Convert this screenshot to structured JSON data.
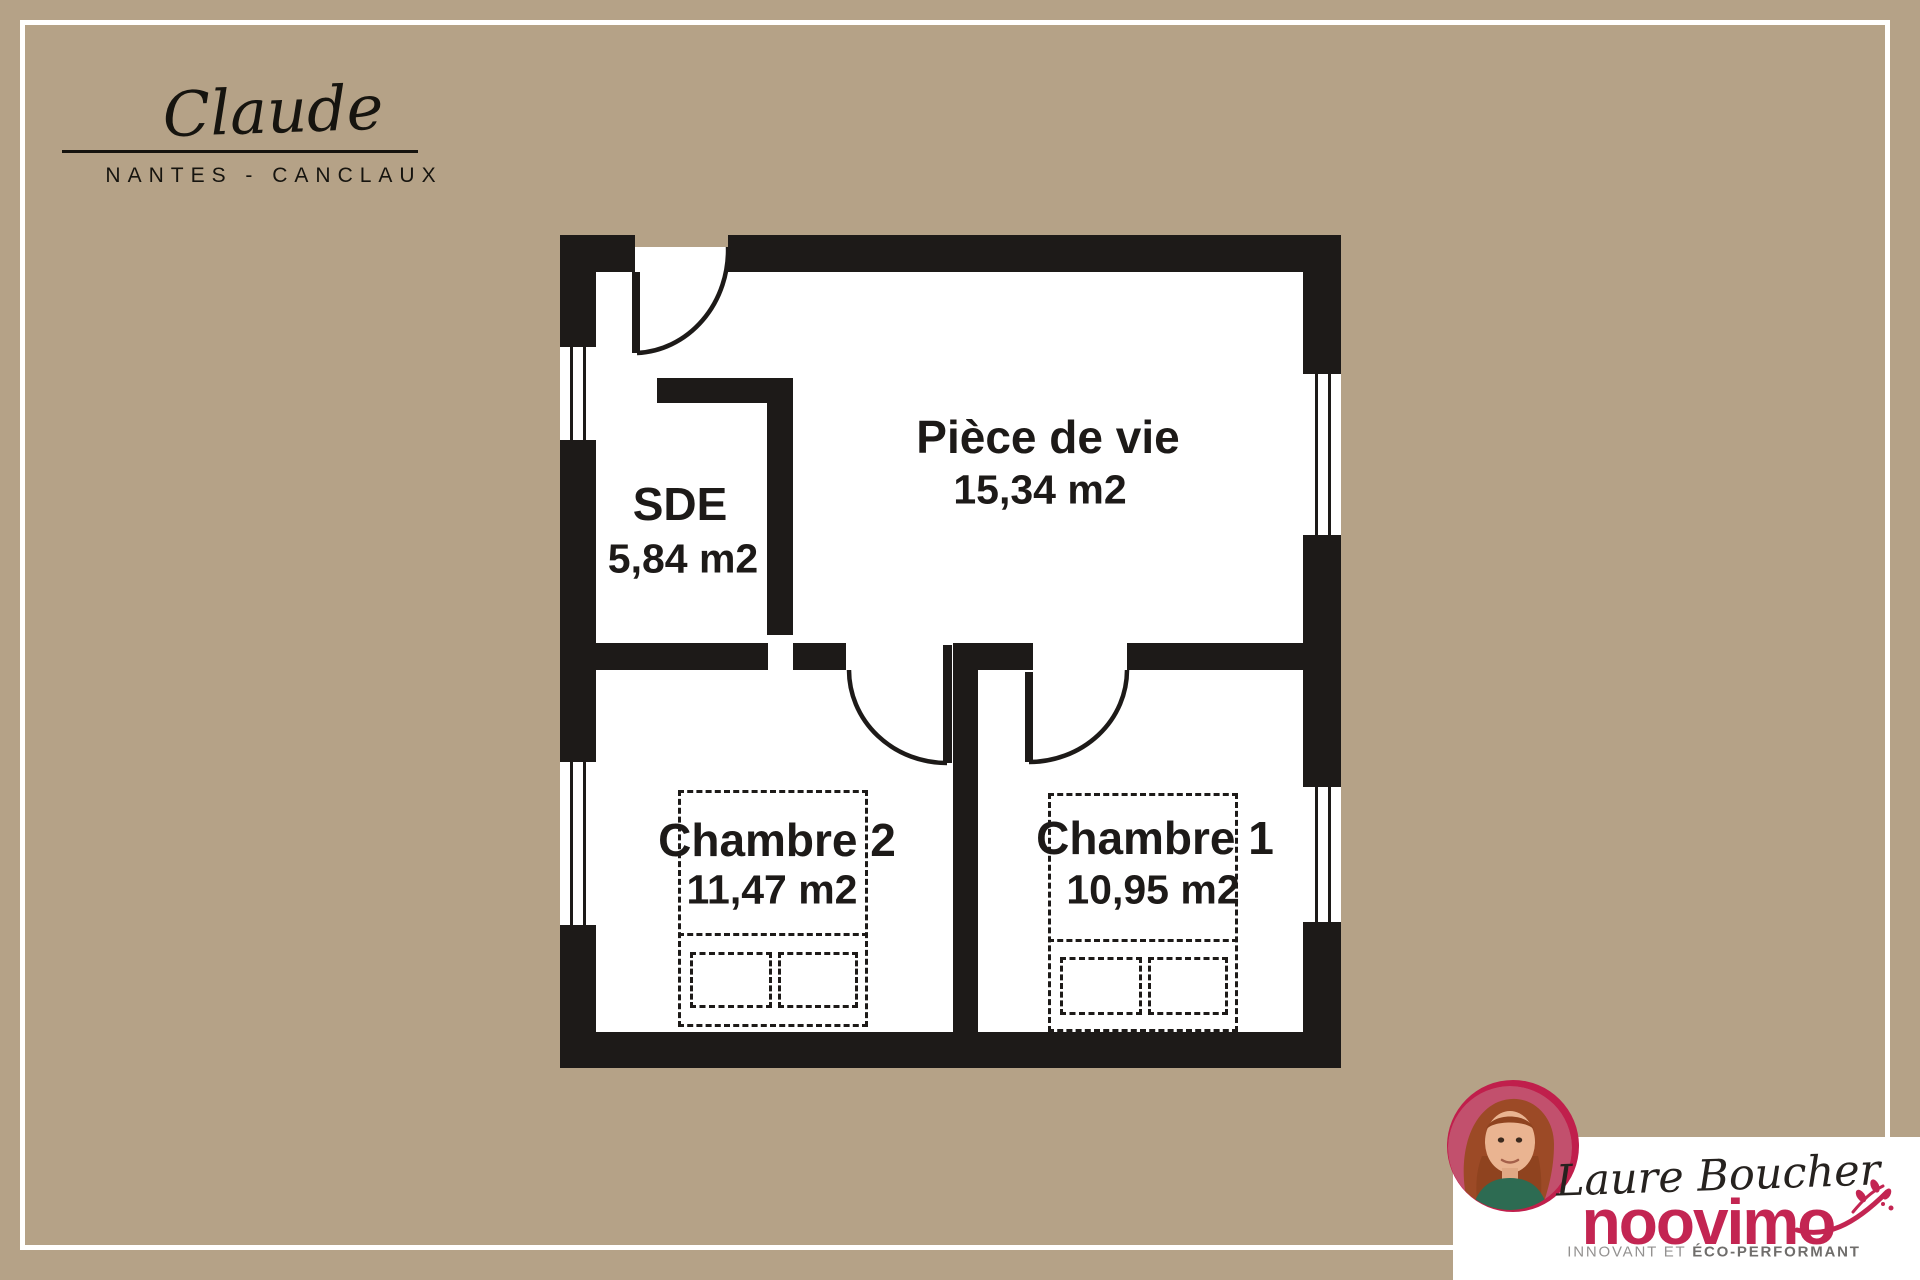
{
  "branding": {
    "name": "Claude",
    "location": "NANTES - CANCLAUX"
  },
  "plan": {
    "rooms": [
      {
        "name": "Pièce de vie",
        "area": "15,34 m2"
      },
      {
        "name": "SDE",
        "area": "5,84 m2"
      },
      {
        "name": "Chambre 2",
        "area": "11,47 m2"
      },
      {
        "name": "Chambre 1",
        "area": "10,95 m2"
      }
    ]
  },
  "agent": {
    "name": "Laure Boucher",
    "brand": "noovimo",
    "tagline_1": "INNOVANT ET ",
    "tagline_2": "ÉCO-PERFORMANT"
  },
  "colors": {
    "background": "#b5a287",
    "wall": "#1d1a18",
    "accent": "#c01f4c",
    "card": "#ffffff"
  }
}
